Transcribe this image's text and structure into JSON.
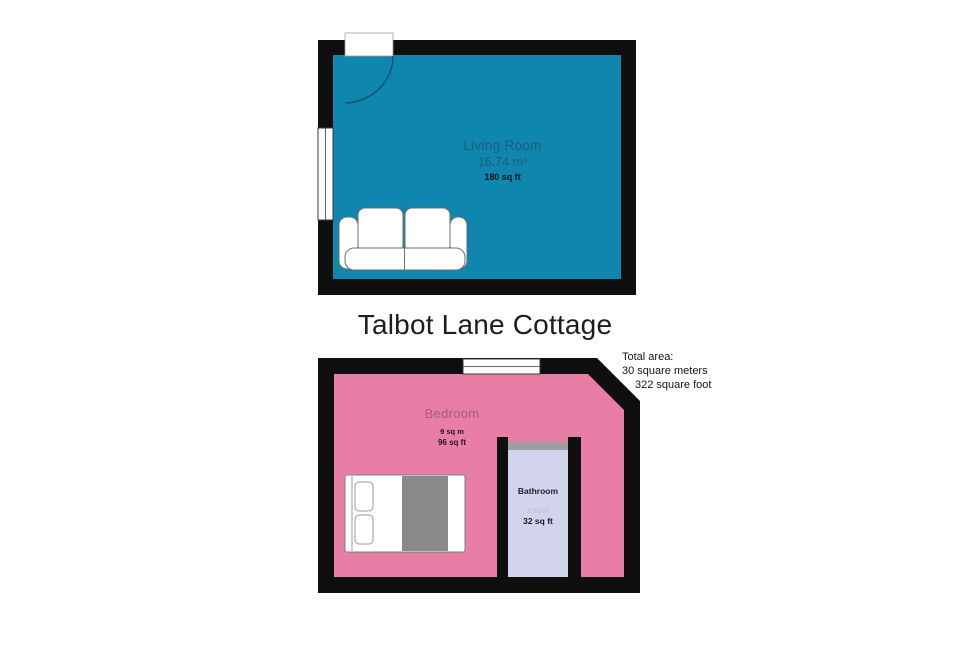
{
  "title": "Talbot Lane Cottage",
  "total_area": {
    "line1": "Total area:",
    "line2": "30 square meters",
    "line3": "322 square foot"
  },
  "floors": {
    "upper": {
      "living_room": {
        "name": "Living Room",
        "area_m2": "16.74 m²",
        "area_ft": "180 sq ft"
      }
    },
    "lower": {
      "bedroom": {
        "name": "Bedroom",
        "area_m2": "9 sq m",
        "area_ft": "96 sq ft"
      },
      "bathroom": {
        "name": "Bathroom",
        "area_m2": "3 sq m",
        "area_ft": "32 sq ft"
      }
    }
  },
  "colors": {
    "wall": "#0f0f0f",
    "living_room_floor": "#0e86ad",
    "bedroom_floor": "#e87ea6",
    "bathroom_floor": "#d2d4ee",
    "furniture": "#ffffff",
    "blanket": "#8a8a8a",
    "counter_gray": "#9e9e9e"
  }
}
